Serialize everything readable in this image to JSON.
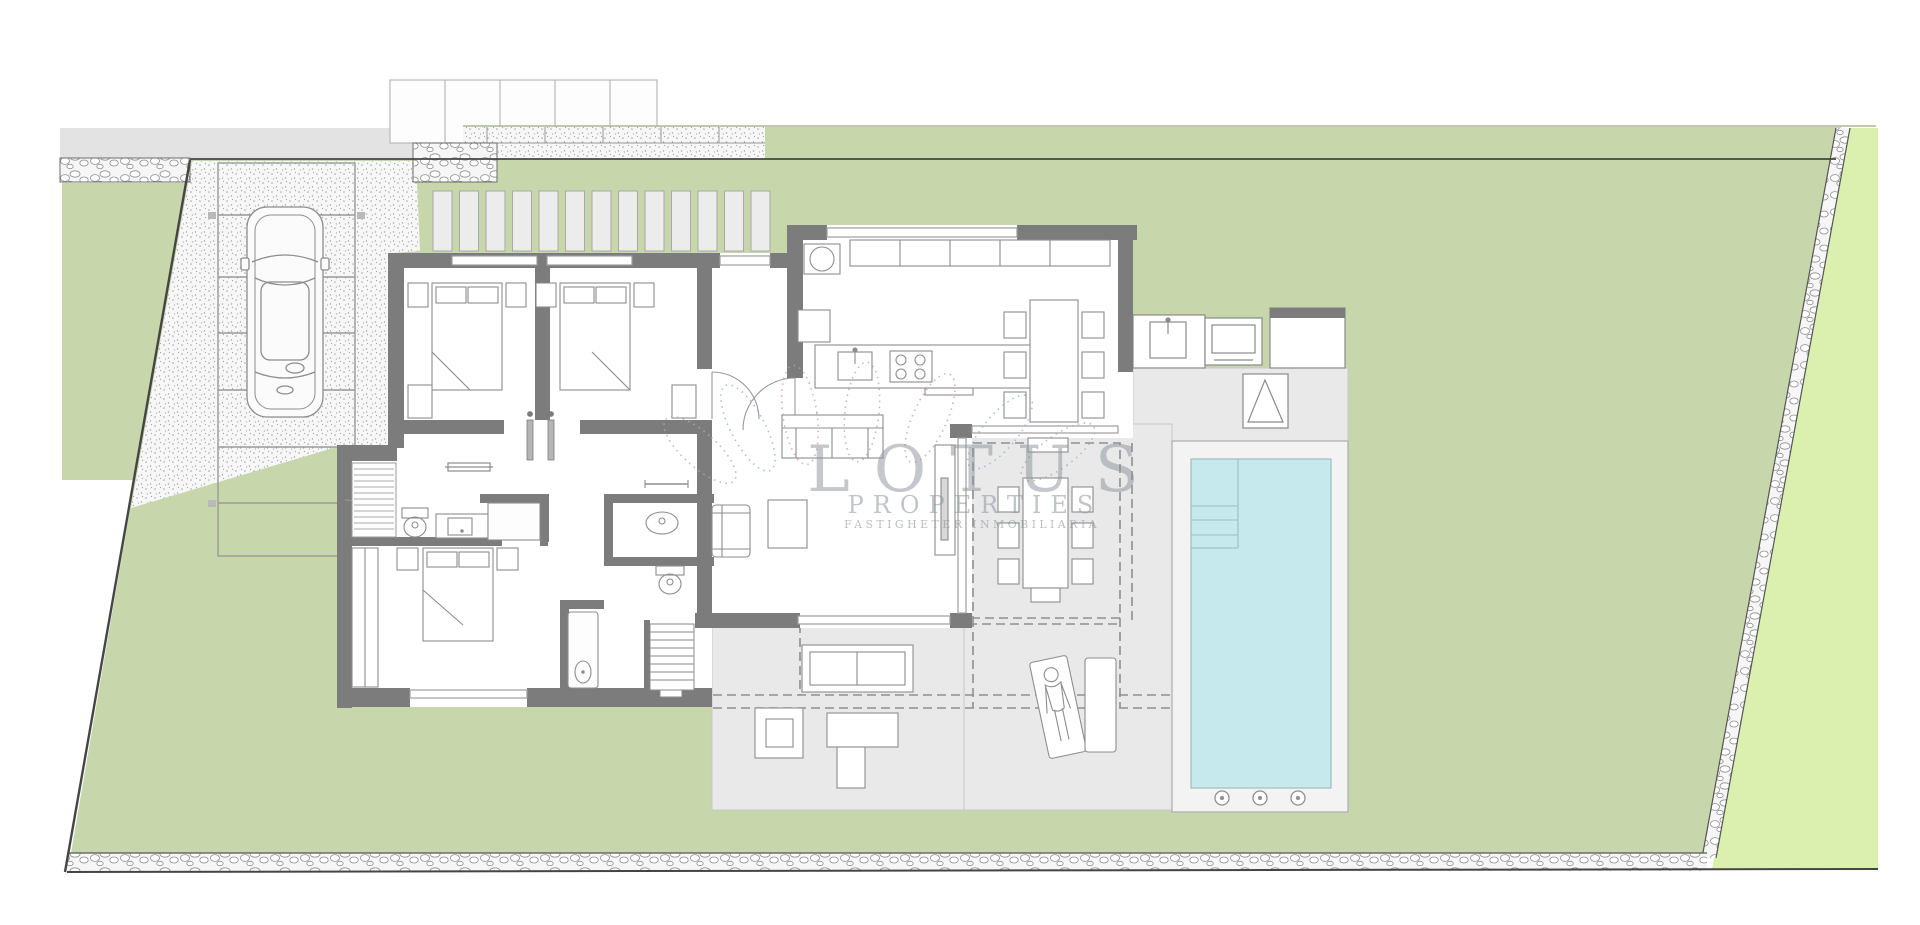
{
  "watermark": {
    "title": "LOTUS",
    "subtitle": "PROPERTIES",
    "tagline": "FASTIGHETER  INMOBILIARIA"
  },
  "palette": {
    "garden": "#c8d6ab",
    "outer_green": "#dbefae",
    "road": "#e3e3e3",
    "terrace": "#e9e9e9",
    "deck": "#f3f3f3",
    "pool": "#c6e9ed",
    "pool_edge": "#9fbcc0",
    "wall": "#7c7c7c",
    "wall_light": "#cccccc",
    "glass": "#9e9e9e",
    "furn": "#8d8d8d",
    "stipple_dot": "#a3a3a3",
    "pebble": "#909090",
    "boundary": "#454545",
    "dash": "#8f8f8f",
    "watermark_gray": "#8e949c",
    "petal_red": "#c99f9f",
    "petal_blue": "#97b3cd"
  },
  "features": [
    "plot-boundary",
    "street",
    "gravel-driveway",
    "parking-bay",
    "car-icon",
    "pergola-slats",
    "neighbor-pergola",
    "garden-lawn",
    "stone-wall",
    "bedroom-1",
    "bedroom-2",
    "master-bedroom",
    "bathrooms",
    "laundry-closet",
    "hallway",
    "kitchen",
    "kitchen-island",
    "indoor-dining-table",
    "living-sofa",
    "armchair",
    "coffee-table",
    "tv-console",
    "stairs",
    "covered-terrace",
    "outdoor-dining-table",
    "outdoor-kitchen",
    "bbq-grill",
    "outdoor-shower",
    "outdoor-sofa",
    "side-table",
    "sun-lounger",
    "sun-lounger-person",
    "swimming-pool",
    "pool-steps",
    "pool-deck",
    "pool-jets"
  ]
}
